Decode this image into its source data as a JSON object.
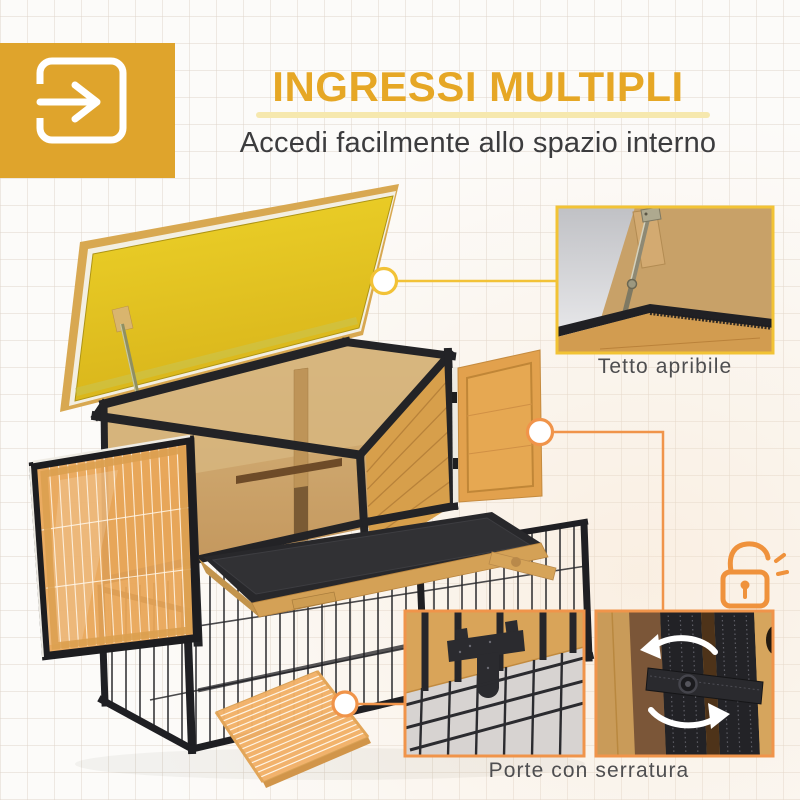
{
  "header": {
    "icon": "enter-arrow-icon",
    "title": "INGRESSI MULTIPLI",
    "subtitle": "Accedi facilmente allo spazio interno"
  },
  "captions": {
    "roof": "Tetto apribile",
    "lock": "Porte con serratura"
  },
  "photo": {
    "description": "Conigliera in legno a due livelli con tetto giallo sollevato, porte anteriori aperte, vassoio estraibile, recinto in rete metallica e rampa di accesso"
  },
  "colors": {
    "brand_yellow": "#DFA42C",
    "title_gold": "#E6A725",
    "underline_pale_yellow": "#F6E8AE",
    "subtitle_gray": "#3C3C3E",
    "caption_gray": "#4E4E50",
    "callout_ring_yellow": "#F2C237",
    "callout_ring_orange": "#F0944A",
    "padlock_orange": "#EF923C",
    "roof_lid_yellow": "#E6C51F",
    "frame_black": "#232326",
    "wood_orange": "#E2A14D",
    "plywood_tan": "#CDA56C",
    "tray_black": "#2A2A2D"
  }
}
